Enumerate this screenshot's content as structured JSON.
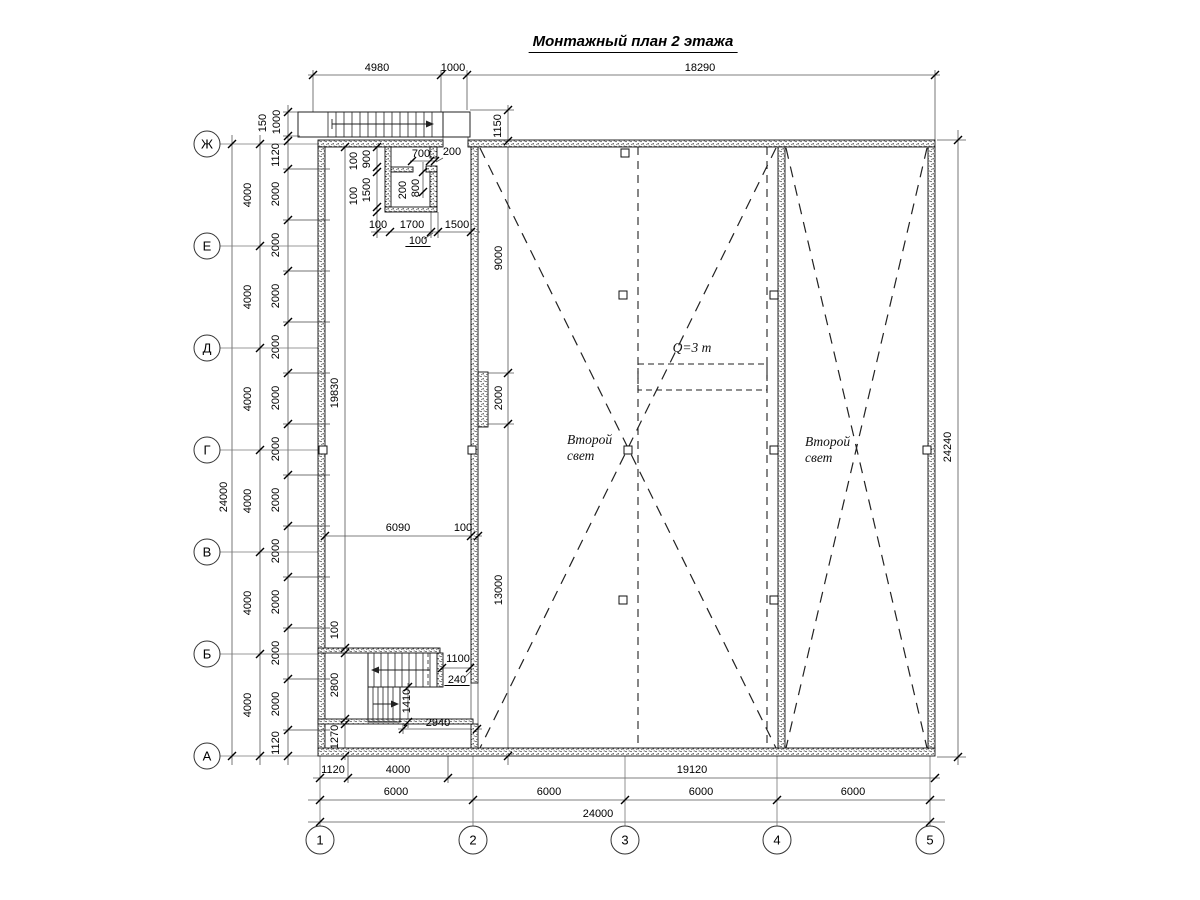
{
  "title": "Монтажный план 2 этажа",
  "annotations": {
    "crane_label": {
      "t": "Q=3 т",
      "x": 692,
      "y": 352
    },
    "void_labels": [
      {
        "lines": [
          "Второй",
          "свет"
        ],
        "x": 567,
        "y": 444
      },
      {
        "lines": [
          "Второй",
          "свет"
        ],
        "x": 805,
        "y": 446
      }
    ]
  },
  "axes": {
    "bottom": [
      {
        "label": "1",
        "x": 320
      },
      {
        "label": "2",
        "x": 473
      },
      {
        "label": "3",
        "x": 625
      },
      {
        "label": "4",
        "x": 777
      },
      {
        "label": "5",
        "x": 930
      }
    ],
    "left": [
      {
        "label": "Ж",
        "y": 144
      },
      {
        "label": "Е",
        "y": 246
      },
      {
        "label": "Д",
        "y": 348
      },
      {
        "label": "Г",
        "y": 450
      },
      {
        "label": "В",
        "y": 552
      },
      {
        "label": "Б",
        "y": 654
      },
      {
        "label": "А",
        "y": 756
      }
    ]
  },
  "dimensions": [
    {
      "t": "4980",
      "x": 377,
      "y": 71
    },
    {
      "t": "1000",
      "x": 453,
      "y": 71
    },
    {
      "t": "18290",
      "x": 700,
      "y": 71
    },
    {
      "t": "150",
      "x": 266,
      "y": 123,
      "r": 1
    },
    {
      "t": "1000",
      "x": 280,
      "y": 122,
      "r": 1
    },
    {
      "t": "1150",
      "x": 501,
      "y": 126,
      "r": 1
    },
    {
      "t": "24000",
      "x": 227,
      "y": 497,
      "r": 1
    },
    {
      "t": "4000",
      "x": 251,
      "y": 195,
      "r": 1
    },
    {
      "t": "4000",
      "x": 251,
      "y": 297,
      "r": 1
    },
    {
      "t": "4000",
      "x": 251,
      "y": 399,
      "r": 1
    },
    {
      "t": "4000",
      "x": 251,
      "y": 501,
      "r": 1
    },
    {
      "t": "4000",
      "x": 251,
      "y": 603,
      "r": 1
    },
    {
      "t": "4000",
      "x": 251,
      "y": 705,
      "r": 1
    },
    {
      "t": "1120",
      "x": 279,
      "y": 155,
      "r": 1
    },
    {
      "t": "2000",
      "x": 279,
      "y": 194,
      "r": 1
    },
    {
      "t": "2000",
      "x": 279,
      "y": 245,
      "r": 1
    },
    {
      "t": "2000",
      "x": 279,
      "y": 296,
      "r": 1
    },
    {
      "t": "2000",
      "x": 279,
      "y": 347,
      "r": 1
    },
    {
      "t": "2000",
      "x": 279,
      "y": 398,
      "r": 1
    },
    {
      "t": "2000",
      "x": 279,
      "y": 449,
      "r": 1
    },
    {
      "t": "2000",
      "x": 279,
      "y": 500,
      "r": 1
    },
    {
      "t": "2000",
      "x": 279,
      "y": 551,
      "r": 1
    },
    {
      "t": "2000",
      "x": 279,
      "y": 602,
      "r": 1
    },
    {
      "t": "2000",
      "x": 279,
      "y": 653,
      "r": 1
    },
    {
      "t": "2000",
      "x": 279,
      "y": 704,
      "r": 1
    },
    {
      "t": "1120",
      "x": 279,
      "y": 743,
      "r": 1
    },
    {
      "t": "9000",
      "x": 502,
      "y": 258,
      "r": 1
    },
    {
      "t": "2000",
      "x": 502,
      "y": 398,
      "r": 1
    },
    {
      "t": "13000",
      "x": 502,
      "y": 590,
      "r": 1
    },
    {
      "t": "24240",
      "x": 951,
      "y": 447,
      "r": 1
    },
    {
      "t": "100",
      "x": 357,
      "y": 161,
      "r": 1
    },
    {
      "t": "900",
      "x": 370,
      "y": 159,
      "r": 1
    },
    {
      "t": "100",
      "x": 357,
      "y": 196,
      "r": 1
    },
    {
      "t": "1500",
      "x": 370,
      "y": 190,
      "r": 1
    },
    {
      "t": "700",
      "x": 421,
      "y": 157
    },
    {
      "t": "200",
      "x": 452,
      "y": 155
    },
    {
      "t": "200",
      "x": 406,
      "y": 190,
      "r": 1
    },
    {
      "t": "800",
      "x": 419,
      "y": 188,
      "r": 1
    },
    {
      "t": "100",
      "x": 378,
      "y": 228
    },
    {
      "t": "1700",
      "x": 412,
      "y": 228
    },
    {
      "t": "1500",
      "x": 457,
      "y": 228
    },
    {
      "t": "100",
      "x": 418,
      "y": 244,
      "u": 1
    },
    {
      "t": "19830",
      "x": 338,
      "y": 393,
      "r": 1
    },
    {
      "t": "6090",
      "x": 398,
      "y": 531
    },
    {
      "t": "100",
      "x": 463,
      "y": 531
    },
    {
      "t": "100",
      "x": 338,
      "y": 630,
      "r": 1
    },
    {
      "t": "2800",
      "x": 338,
      "y": 685,
      "r": 1
    },
    {
      "t": "1270",
      "x": 338,
      "y": 737,
      "r": 1
    },
    {
      "t": "1100",
      "x": 458,
      "y": 662
    },
    {
      "t": "240",
      "x": 457,
      "y": 683,
      "u": 1
    },
    {
      "t": "1410",
      "x": 410,
      "y": 701,
      "r": 1
    },
    {
      "t": "2940",
      "x": 438,
      "y": 726
    },
    {
      "t": "1120",
      "x": 333,
      "y": 773
    },
    {
      "t": "4000",
      "x": 398,
      "y": 773
    },
    {
      "t": "19120",
      "x": 692,
      "y": 773
    },
    {
      "t": "6000",
      "x": 396,
      "y": 795
    },
    {
      "t": "6000",
      "x": 549,
      "y": 795
    },
    {
      "t": "6000",
      "x": 701,
      "y": 795
    },
    {
      "t": "6000",
      "x": 853,
      "y": 795
    },
    {
      "t": "24000",
      "x": 598,
      "y": 817
    }
  ]
}
